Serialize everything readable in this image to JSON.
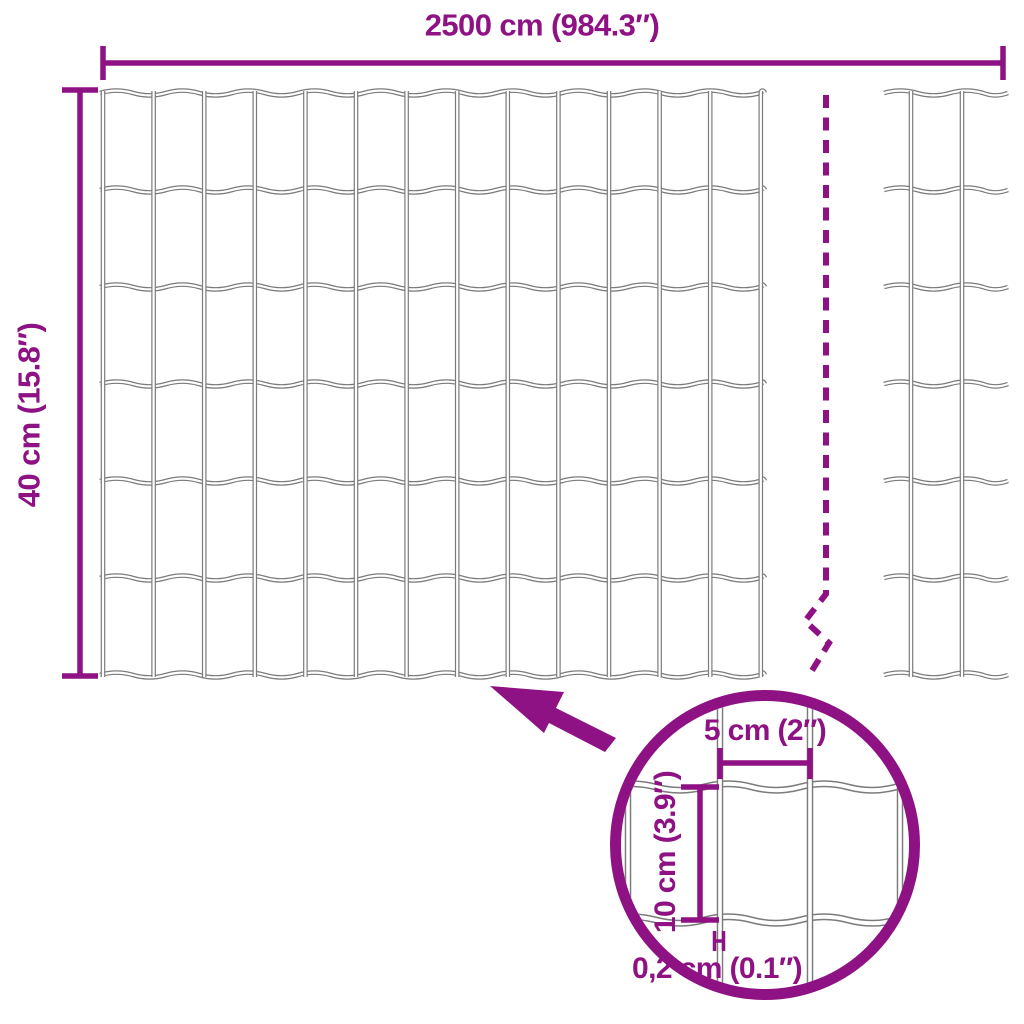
{
  "labels": {
    "overall_width": "2500 cm (984.3″)",
    "overall_height": "40 cm (15.8″)",
    "cell_width": "5 cm (2″)",
    "cell_height": "10 cm (3.9″)",
    "wire_thickness": "0,2 cm (0.1″)"
  },
  "colors": {
    "accent": "#8E1283",
    "wire": "#7B7B7B",
    "background": "#FFFFFF"
  },
  "icons": {
    "pointer_arrow": "arrow-up-left-icon",
    "detail_view": "magnifier-circle",
    "break_line": "dashed-break-line"
  }
}
